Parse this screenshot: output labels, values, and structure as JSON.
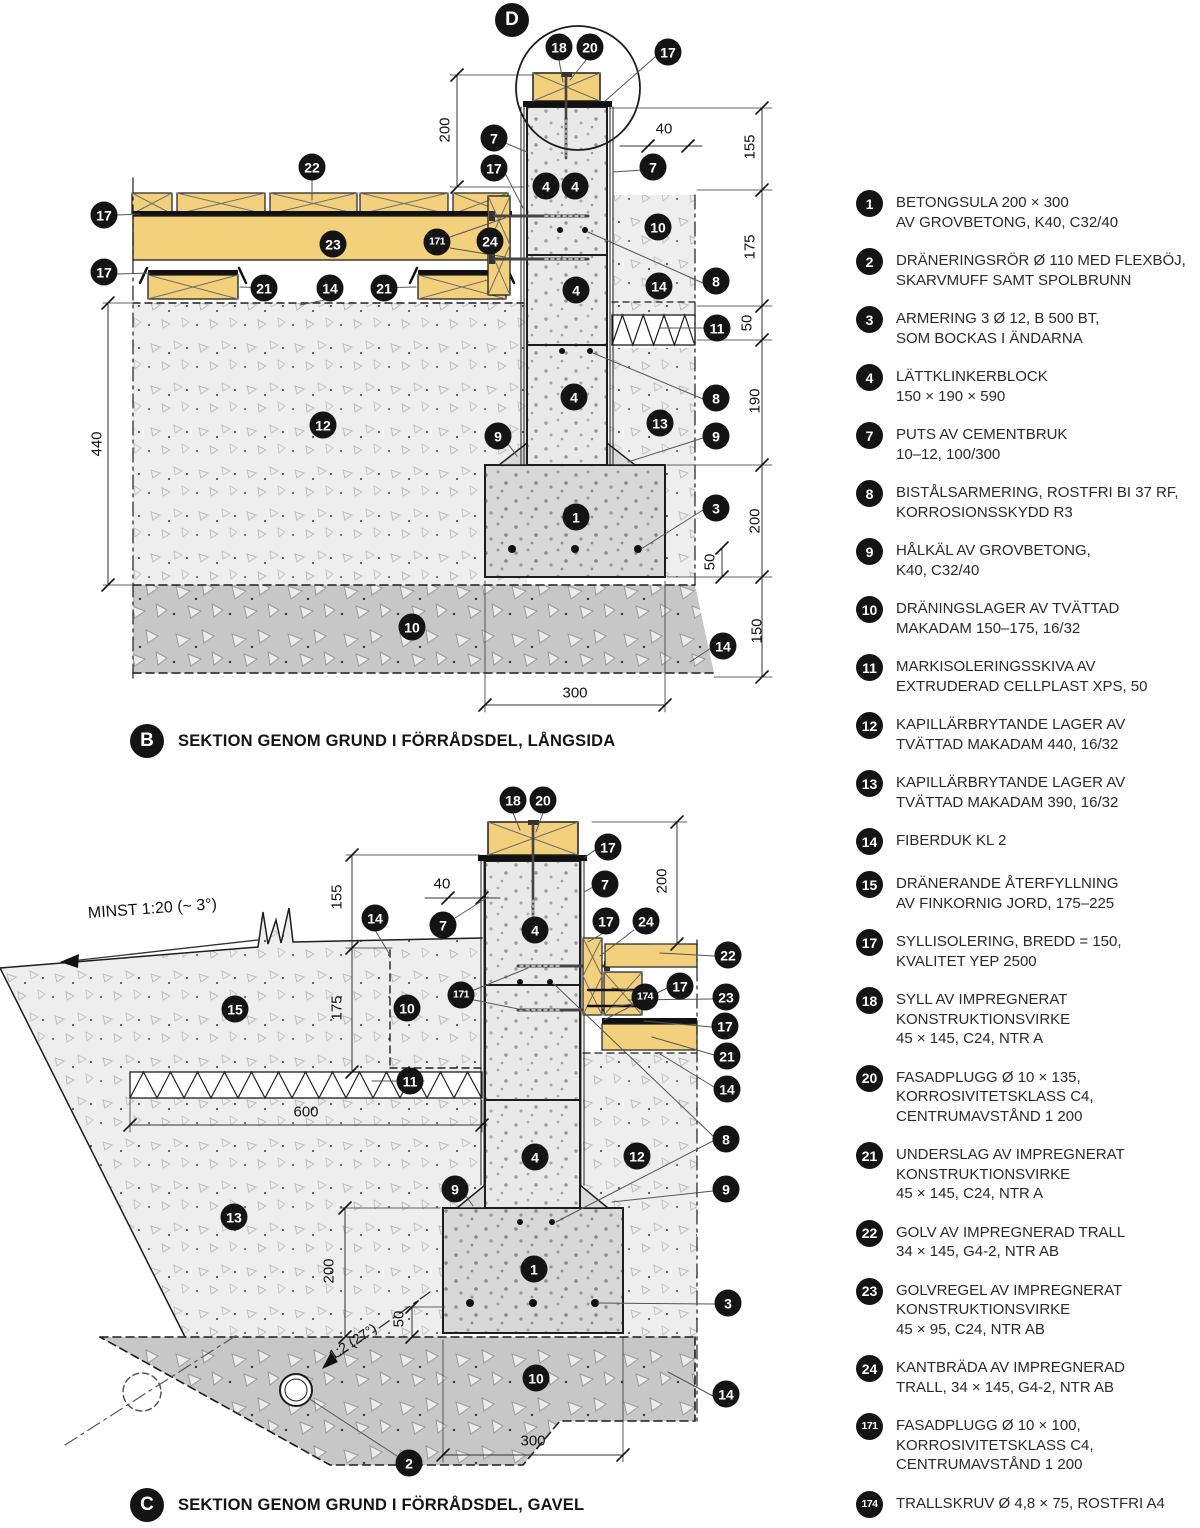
{
  "sections": {
    "b": {
      "letter": "B",
      "title": "SEKTION GENOM GRUND I FÖRRÅDSDEL, LÅNGSIDA"
    },
    "c": {
      "letter": "C",
      "title": "SEKTION GENOM GRUND I FÖRRÅDSDEL, GAVEL"
    },
    "d_letter": "D"
  },
  "notes": {
    "slope": "MINST 1:20 (~ 3°)",
    "footing_slope": "1:2 (27°)"
  },
  "colors": {
    "wood": "#f3d17c",
    "block_fill": "#e9e9e9",
    "footing_fill": "#d8d8d8",
    "gravel_light": "#eeeeee",
    "gravel_dark": "#c7c7c7",
    "line": "#1d1d1d",
    "callout_bg": "#141414",
    "callout_text": "#ffffff"
  },
  "callouts": [
    {
      "n": "18",
      "x": 559,
      "y": 47
    },
    {
      "n": "20",
      "x": 590,
      "y": 47
    },
    {
      "n": "17",
      "x": 668,
      "y": 52
    },
    {
      "n": "7",
      "x": 494,
      "y": 138
    },
    {
      "n": "17",
      "x": 494,
      "y": 168
    },
    {
      "n": "4",
      "x": 546,
      "y": 186
    },
    {
      "n": "4",
      "x": 575,
      "y": 186
    },
    {
      "n": "7",
      "x": 653,
      "y": 167
    },
    {
      "n": "22",
      "x": 312,
      "y": 167
    },
    {
      "n": "17",
      "x": 104,
      "y": 215
    },
    {
      "n": "23",
      "x": 333,
      "y": 244
    },
    {
      "n": "171",
      "x": 437,
      "y": 242
    },
    {
      "n": "24",
      "x": 490,
      "y": 241
    },
    {
      "n": "17",
      "x": 104,
      "y": 272
    },
    {
      "n": "21",
      "x": 264,
      "y": 288
    },
    {
      "n": "14",
      "x": 330,
      "y": 288
    },
    {
      "n": "21",
      "x": 384,
      "y": 288
    },
    {
      "n": "10",
      "x": 658,
      "y": 227
    },
    {
      "n": "14",
      "x": 659,
      "y": 286
    },
    {
      "n": "8",
      "x": 716,
      "y": 281
    },
    {
      "n": "11",
      "x": 717,
      "y": 328
    },
    {
      "n": "4",
      "x": 576,
      "y": 290
    },
    {
      "n": "4",
      "x": 574,
      "y": 397
    },
    {
      "n": "12",
      "x": 323,
      "y": 425
    },
    {
      "n": "13",
      "x": 660,
      "y": 423
    },
    {
      "n": "9",
      "x": 498,
      "y": 436
    },
    {
      "n": "9",
      "x": 716,
      "y": 436
    },
    {
      "n": "8",
      "x": 716,
      "y": 398
    },
    {
      "n": "1",
      "x": 576,
      "y": 517
    },
    {
      "n": "3",
      "x": 716,
      "y": 508
    },
    {
      "n": "10",
      "x": 412,
      "y": 627
    },
    {
      "n": "14",
      "x": 723,
      "y": 646
    },
    {
      "n": "18",
      "x": 513,
      "y": 800
    },
    {
      "n": "20",
      "x": 543,
      "y": 800
    },
    {
      "n": "17",
      "x": 608,
      "y": 847
    },
    {
      "n": "7",
      "x": 605,
      "y": 884
    },
    {
      "n": "7",
      "x": 443,
      "y": 925
    },
    {
      "n": "14",
      "x": 375,
      "y": 918
    },
    {
      "n": "4",
      "x": 535,
      "y": 930
    },
    {
      "n": "17",
      "x": 606,
      "y": 921
    },
    {
      "n": "24",
      "x": 646,
      "y": 921
    },
    {
      "n": "22",
      "x": 728,
      "y": 955
    },
    {
      "n": "15",
      "x": 235,
      "y": 1009
    },
    {
      "n": "10",
      "x": 407,
      "y": 1008
    },
    {
      "n": "171",
      "x": 461,
      "y": 995
    },
    {
      "n": "174",
      "x": 645,
      "y": 997
    },
    {
      "n": "17",
      "x": 680,
      "y": 986
    },
    {
      "n": "23",
      "x": 726,
      "y": 997
    },
    {
      "n": "17",
      "x": 725,
      "y": 1026
    },
    {
      "n": "21",
      "x": 727,
      "y": 1056
    },
    {
      "n": "14",
      "x": 727,
      "y": 1089
    },
    {
      "n": "11",
      "x": 410,
      "y": 1081
    },
    {
      "n": "8",
      "x": 726,
      "y": 1139
    },
    {
      "n": "12",
      "x": 637,
      "y": 1156
    },
    {
      "n": "9",
      "x": 455,
      "y": 1189
    },
    {
      "n": "9",
      "x": 726,
      "y": 1189
    },
    {
      "n": "13",
      "x": 234,
      "y": 1217
    },
    {
      "n": "4",
      "x": 535,
      "y": 1157
    },
    {
      "n": "1",
      "x": 534,
      "y": 1269
    },
    {
      "n": "3",
      "x": 728,
      "y": 1303
    },
    {
      "n": "10",
      "x": 536,
      "y": 1378
    },
    {
      "n": "2",
      "x": 409,
      "y": 1463
    },
    {
      "n": "14",
      "x": 726,
      "y": 1394
    }
  ],
  "dimensions": [
    {
      "text": "200",
      "x": 445,
      "y": 130,
      "rot": true
    },
    {
      "text": "40",
      "x": 664,
      "y": 129
    },
    {
      "text": "155",
      "x": 750,
      "y": 147,
      "rot": true
    },
    {
      "text": "175",
      "x": 750,
      "y": 247,
      "rot": true
    },
    {
      "text": "50",
      "x": 747,
      "y": 323,
      "rot": true
    },
    {
      "text": "190",
      "x": 755,
      "y": 401,
      "rot": true
    },
    {
      "text": "200",
      "x": 755,
      "y": 521,
      "rot": true
    },
    {
      "text": "50",
      "x": 710,
      "y": 562,
      "rot": true
    },
    {
      "text": "150",
      "x": 757,
      "y": 631,
      "rot": true
    },
    {
      "text": "440",
      "x": 97,
      "y": 444,
      "rot": true
    },
    {
      "text": "300",
      "x": 575,
      "y": 693
    },
    {
      "text": "155",
      "x": 337,
      "y": 897,
      "rot": true
    },
    {
      "text": "175",
      "x": 337,
      "y": 1008,
      "rot": true
    },
    {
      "text": "40",
      "x": 442,
      "y": 884
    },
    {
      "text": "200",
      "x": 662,
      "y": 881,
      "rot": true
    },
    {
      "text": "600",
      "x": 306,
      "y": 1112
    },
    {
      "text": "200",
      "x": 329,
      "y": 1271,
      "rot": true
    },
    {
      "text": "50",
      "x": 399,
      "y": 1319,
      "rot": true
    },
    {
      "text": "300",
      "x": 533,
      "y": 1441
    }
  ],
  "legend": {
    "items": [
      {
        "n": "1",
        "text": "BETONGSULA 200 × 300\nAV GROVBETONG, K40, C32/40"
      },
      {
        "n": "2",
        "text": "DRÄNERINGSRÖR Ø 110 MED FLEXBÖJ,\nSKARVMUFF SAMT SPOLBRUNN"
      },
      {
        "n": "3",
        "text": "ARMERING 3 Ø 12, B 500 BT,\nSOM BOCKAS I ÄNDARNA"
      },
      {
        "n": "4",
        "text": "LÄTTKLINKERBLOCK\n150 × 190 × 590"
      },
      {
        "n": "7",
        "text": "PUTS AV CEMENTBRUK\n10–12, 100/300"
      },
      {
        "n": "8",
        "text": "BISTÅLSARMERING, ROSTFRI BI 37 RF,\nKORROSIONSSKYDD R3"
      },
      {
        "n": "9",
        "text": "HÅLKÄL AV GROVBETONG,\nK40, C32/40"
      },
      {
        "n": "10",
        "text": "DRÄNINGSLAGER AV TVÄTTAD\nMAKADAM 150–175, 16/32"
      },
      {
        "n": "11",
        "text": "MARKISOLERINGSSKIVA AV\nEXTRUDERAD CELLPLAST XPS, 50"
      },
      {
        "n": "12",
        "text": "KAPILLÄRBRYTANDE LAGER AV\nTVÄTTAD MAKADAM 440, 16/32"
      },
      {
        "n": "13",
        "text": "KAPILLÄRBRYTANDE LAGER AV\nTVÄTTAD MAKADAM 390, 16/32"
      },
      {
        "n": "14",
        "text": "FIBERDUK KL 2"
      },
      {
        "n": "15",
        "text": "DRÄNERANDE ÅTERFYLLNING\nAV FINKORNIG JORD, 175–225"
      },
      {
        "n": "17",
        "text": "SYLLISOLERING, BREDD = 150,\nKVALITET YEP 2500"
      },
      {
        "n": "18",
        "text": "SYLL AV IMPREGNERAT\nKONSTRUKTIONSVIRKE\n45 × 145, C24, NTR A"
      },
      {
        "n": "20",
        "text": "FASADPLUGG Ø 10 × 135,\nKORROSIVITETSKLASS C4,\nCENTRUMAVSTÅND 1 200"
      },
      {
        "n": "21",
        "text": "UNDERSLAG AV IMPREGNERAT\nKONSTRUKTIONSVIRKE\n45 × 145, C24, NTR A"
      },
      {
        "n": "22",
        "text": "GOLV AV IMPREGNERAD TRALL\n34 × 145, G4-2, NTR AB"
      },
      {
        "n": "23",
        "text": "GOLVREGEL AV IMPREGNERAT\nKONSTRUKTIONSVIRKE\n45 × 95, C24, NTR AB"
      },
      {
        "n": "24",
        "text": "KANTBRÄDA AV IMPREGNERAD\nTRALL, 34 × 145, G4-2, NTR AB"
      },
      {
        "n": "171",
        "text": "FASADPLUGG Ø 10 × 100,\nKORROSIVITETSKLASS C4,\nCENTRUMAVSTÅND 1 200"
      },
      {
        "n": "174",
        "text": "TRALLSKRUV Ø 4,8 × 75, ROSTFRI A4"
      }
    ]
  }
}
